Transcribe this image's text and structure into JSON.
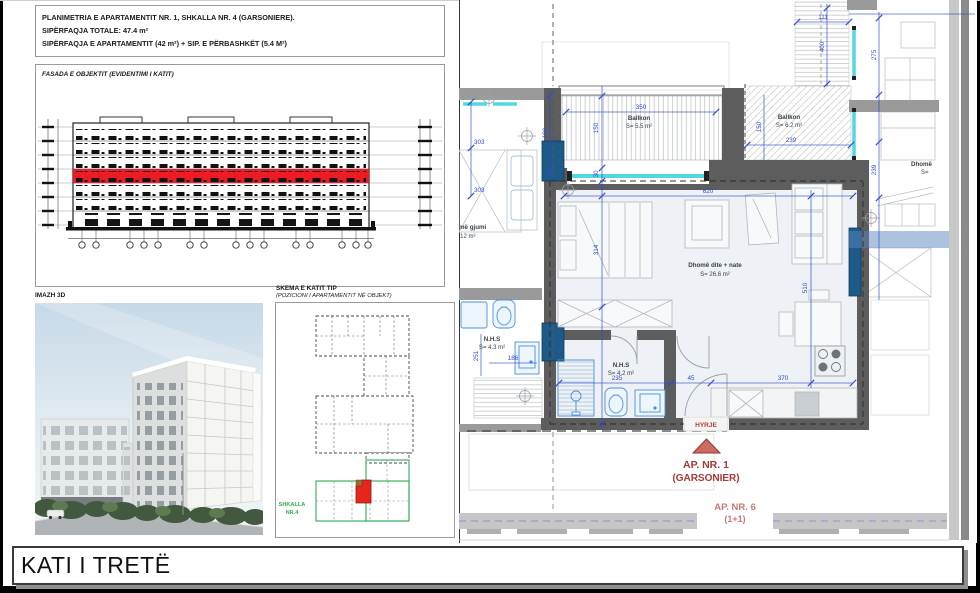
{
  "title_block": {
    "line1": "PLANIMETRIA E APARTAMENTIT NR. 1, SHKALLA NR. 4 (GARSONIERE).",
    "line2": "SIPËRFAQJA TOTALE: 47.4 m²",
    "line3": "SIPËRFAQJA E APARTAMENTIT (42 m²) + SIP. E PËRBASHKËT (5.4 M²)"
  },
  "facade": {
    "label": "FASADA E OBJEKTIT (EVIDENTIMI I KATIT)"
  },
  "image3d": {
    "label": "IMAZH 3D"
  },
  "key_plan": {
    "title": "SKEMA E KATIT TIP",
    "subtitle": "(POZICIONI I APARTAMENTIT NË OBJEKT)",
    "stair_line1": "SHKALLA",
    "stair_line2": "NR.4"
  },
  "plan": {
    "balcony1": {
      "name": "Ballkon",
      "area": "S= 5.5 m²"
    },
    "balcony2": {
      "name": "Ballkon",
      "area": "S= 6.2 m²"
    },
    "living": {
      "name": "Dhomë dite + nate",
      "area": "S= 26.6 m²"
    },
    "bath1": {
      "name": "N.H.S",
      "area": "S= 4.2 m²"
    },
    "bath2": {
      "name": "N.H.S",
      "area": "S= 4.3 m²"
    },
    "bedroom_neighbor": {
      "name": "Dhomë gjumi",
      "area": "S= 12 m²"
    },
    "room_right": {
      "name": "Dhomë",
      "area": "S="
    },
    "entrance": "HYRJE",
    "ap1_line1": "AP. NR. 1",
    "ap1_line2": "(GARSONIER)",
    "ap6_line1": "AP. NR. 6",
    "ap6_line2": "(1+1)",
    "dims": {
      "d350": "350",
      "d150": "150",
      "d30": "30",
      "d190": "190",
      "d314": "314",
      "d620": "620",
      "d303a": "303",
      "d303b": "303",
      "d186": "186",
      "d251": "251",
      "d235": "235",
      "d45": "45",
      "d370": "370",
      "d510": "510",
      "d111": "111",
      "d400": "400",
      "d275": "275",
      "d239v": "239",
      "d239h": "239",
      "d150r": "150"
    }
  },
  "footer": {
    "title": "KATI I TRETË"
  },
  "colors": {
    "dimension_blue": "#2e4bd0",
    "wall_dark": "#5d5d5d",
    "shaft_navy": "#1d5a88",
    "window_cyan": "#52d7e3",
    "highlight_red": "#ed1c24",
    "entrance_red": "#a43a35",
    "neighbor_label_red": "#c27b76",
    "stair_green": "#2fae4d"
  }
}
